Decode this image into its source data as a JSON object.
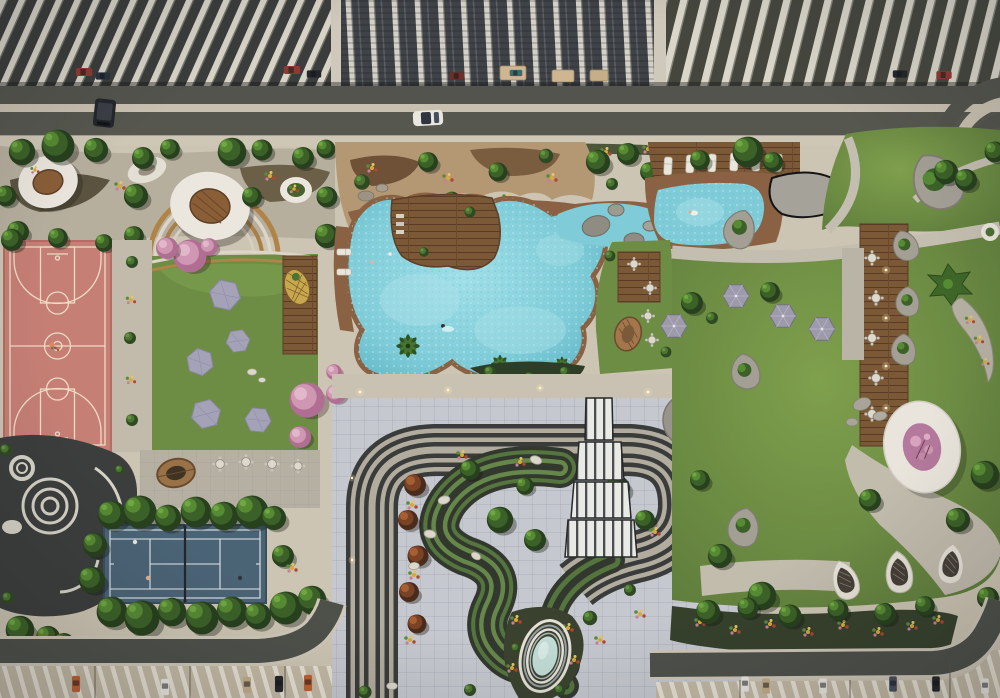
{
  "meta": {
    "title": "Aerial dusk rendering of a residential amenity podium masterplan"
  },
  "colors": {
    "deck_warm": "#cdc5b3",
    "deck_cool": "#c6c8cf",
    "sidewalk": "#cfc7b6",
    "road_asphalt": "#53544d",
    "road_asphalt2": "#56574f",
    "road_median": "#c9c1b0",
    "tower_slat": "#d7d3c7",
    "tower_dark": "#3d403e",
    "roof_beige": "#c3b9a4",
    "pool_water": "#7fccd8",
    "pool_highlight": "#a9e0e7",
    "basketball_court": "#c67f75",
    "basketball_lines": "#eedcc4",
    "tennis_court": "#4a6375",
    "tennis_lines": "#e2e8ec",
    "tennis_net": "#23272b",
    "lawn": "#6d8c44",
    "lawn_light": "#82a04f",
    "wood_deck": "#7b5836",
    "pod_white": "#ece7de",
    "umbrella_gray": "#9d9aac",
    "planter_stone": "#a39f95",
    "track_dark": "#393c3a",
    "track_light": "#b2ac9e",
    "swirl_green": "#55753e",
    "canopy_white": "#e9e9e6",
    "pink_blossom": "#cf97b2",
    "flower_yellow": "#d9a83b",
    "flower_red": "#ae4734",
    "water_feature": "#c2dcd6",
    "car_white": "#e9e7e0",
    "car_orange": "#c06034",
    "car_red": "#8e3a32",
    "car_dark": "#23262b",
    "car_tan": "#c3ab86",
    "car_blue": "#46505e"
  },
  "scene": {
    "features": [
      "high-rise tower rooftops",
      "access road with moving cars",
      "pavilion pod garden",
      "basketball court",
      "cherry-blossom picnic lawn with hex mats",
      "outdoor seating terrace",
      "spiral garden feature",
      "tennis court",
      "rock garden",
      "free-form lagoon pool",
      "kids pool with stepping stones",
      "sun-lounger deck",
      "pool-side dining lawn",
      "drop-off canopy",
      "looping track garden",
      "sunken swirl garden",
      "oval water feature",
      "great lawn with canopy boardwalk",
      "crescent flower bed",
      "pink-tree pavilion ring",
      "hammock garden",
      "perimeter road",
      "podium parking roofs"
    ],
    "counts": {
      "basketball_players": 2,
      "tennis_players": 3,
      "pool_swimmers": 4,
      "picnic_canopies": 5,
      "lawn_umbrellas": 4,
      "hammock_pods": 3,
      "street_cars": 2,
      "parked_cars": 17
    }
  }
}
